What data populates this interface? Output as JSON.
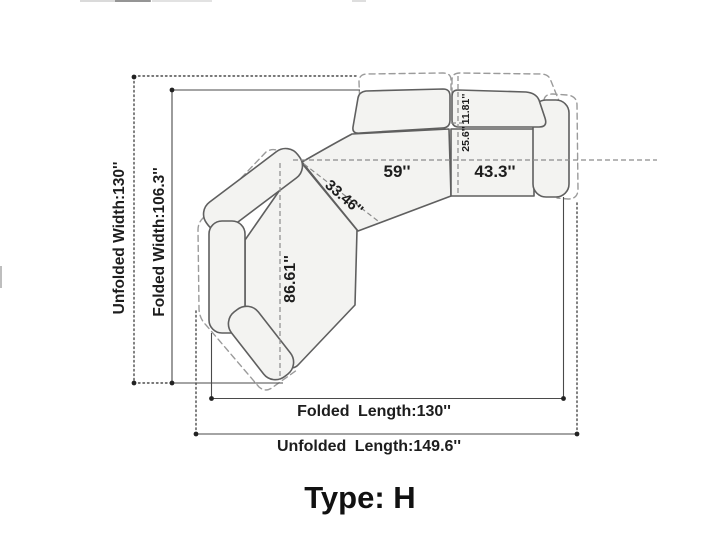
{
  "diagram": {
    "type_label": "Type: H",
    "labels": {
      "unfolded_width": "Unfolded Width:130''",
      "folded_width": "Folded Width:106.3''",
      "folded_length": "Folded Length:130''",
      "unfolded_length": "Unfolded Length:149.6''",
      "middle_seat_width": "59''",
      "right_seat_width": "43.3''",
      "seat_diagonal_depth": "33.46''",
      "chaise_length": "86.61''",
      "backrest_fold_depth": "11.81''",
      "backrest_depth": "25.6''"
    },
    "colors": {
      "background": "#ffffff",
      "sofa_fill": "#f3f3f1",
      "sofa_outline": "#5f5f5f",
      "unfolded_dashed_outline": "#9b9b9b",
      "dimension_line": "#4a4a4a",
      "text": "#1d1d1d"
    }
  }
}
